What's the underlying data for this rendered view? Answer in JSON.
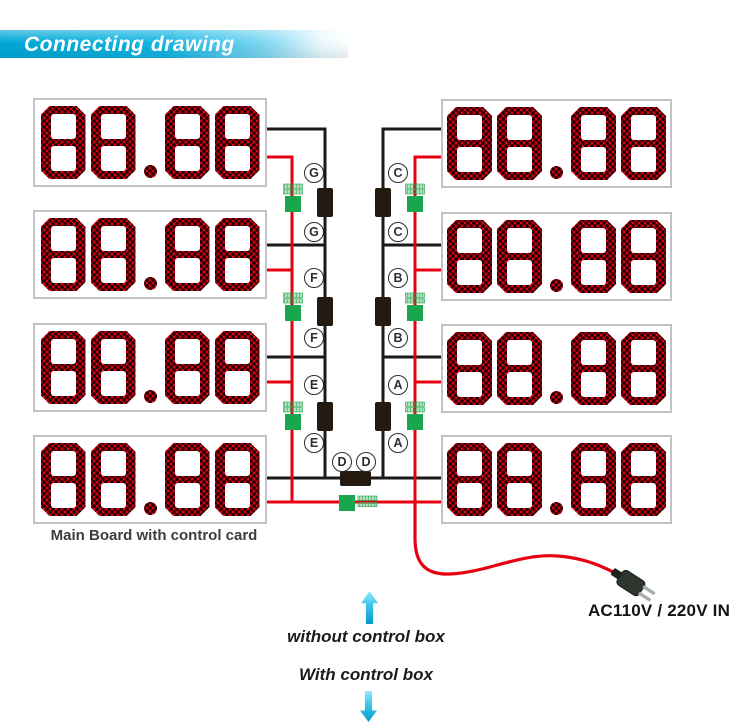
{
  "header": {
    "title": "Connecting drawing"
  },
  "panels": {
    "left": [
      "88.88",
      "88.88",
      "88.88",
      "88.88"
    ],
    "right": [
      "88.88",
      "88.88",
      "88.88",
      "88.88"
    ],
    "main_board_caption": "Main Board with control card"
  },
  "wiring": {
    "left_labels": [
      "G",
      "G",
      "F",
      "F",
      "E",
      "E"
    ],
    "right_labels": [
      "C",
      "C",
      "B",
      "B",
      "A",
      "A"
    ],
    "bottom_labels": [
      "D",
      "D"
    ]
  },
  "power": {
    "ac_input_label": "AC110V / 220V IN"
  },
  "footer": {
    "without_control_box": "without control box",
    "with_control_box": "With control box"
  },
  "icons": {
    "up_arrow": "arrow-up-icon",
    "down_arrow": "arrow-down-icon",
    "plug": "power-plug-icon"
  },
  "colors": {
    "banner_cyan": "#00a7d6",
    "led_red": "#e60013",
    "wire_signal_black": "#1a1a1a",
    "wire_power_red": "#e60012",
    "connector_black": "#241a10",
    "terminal_green": "#1aa64d",
    "arrow_cyan": "#0698cf"
  }
}
